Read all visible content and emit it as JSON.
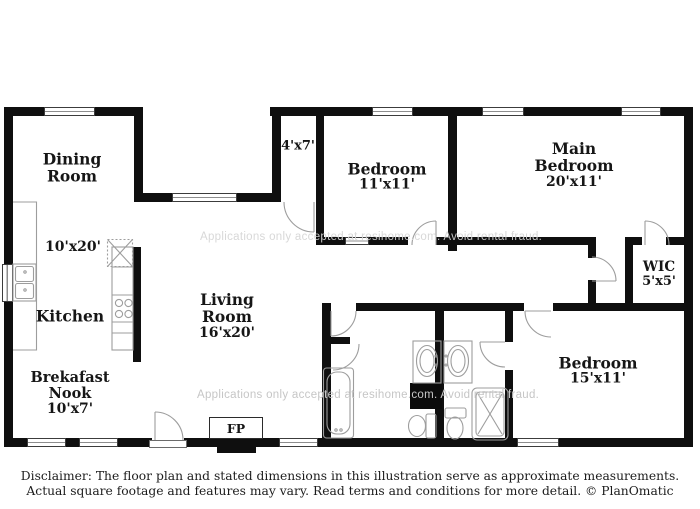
{
  "floorplan": {
    "rooms": {
      "dining": {
        "line1": "Dining",
        "line2": "Room",
        "dim": "10'x20'"
      },
      "entry_hall": {
        "dim": "4'x7'"
      },
      "bedroom_11": {
        "name": "Bedroom",
        "dim": "11'x11'"
      },
      "main_bedroom": {
        "line1": "Main",
        "line2": "Bedroom",
        "dim": "20'x11'"
      },
      "wic": {
        "name": "WIC",
        "dim": "5'x5'"
      },
      "kitchen": {
        "name": "Kitchen"
      },
      "living": {
        "line1": "Living",
        "line2": "Room",
        "dim": "16'x20'"
      },
      "breakfast_nook": {
        "line1": "Brekafast",
        "line2": "Nook",
        "dim": "10'x7'"
      },
      "bedroom_15": {
        "name": "Bedroom",
        "dim": "15'x11'"
      },
      "fireplace": {
        "label": "FP"
      }
    },
    "watermark": {
      "line": "Applications only accepted at resihome.com. Avoid rental fraud."
    },
    "colors": {
      "wall": "#0f0f0f",
      "fixture_outline": "#9d9d9d",
      "watermark": "#c6c6c6"
    }
  },
  "footer": {
    "line1": "Disclaimer: The floor plan and stated dimensions in this illustration serve as approximate measurements.",
    "line2": "Actual square footage and features may vary. Read terms and conditions for more detail. © PlanOmatic"
  }
}
